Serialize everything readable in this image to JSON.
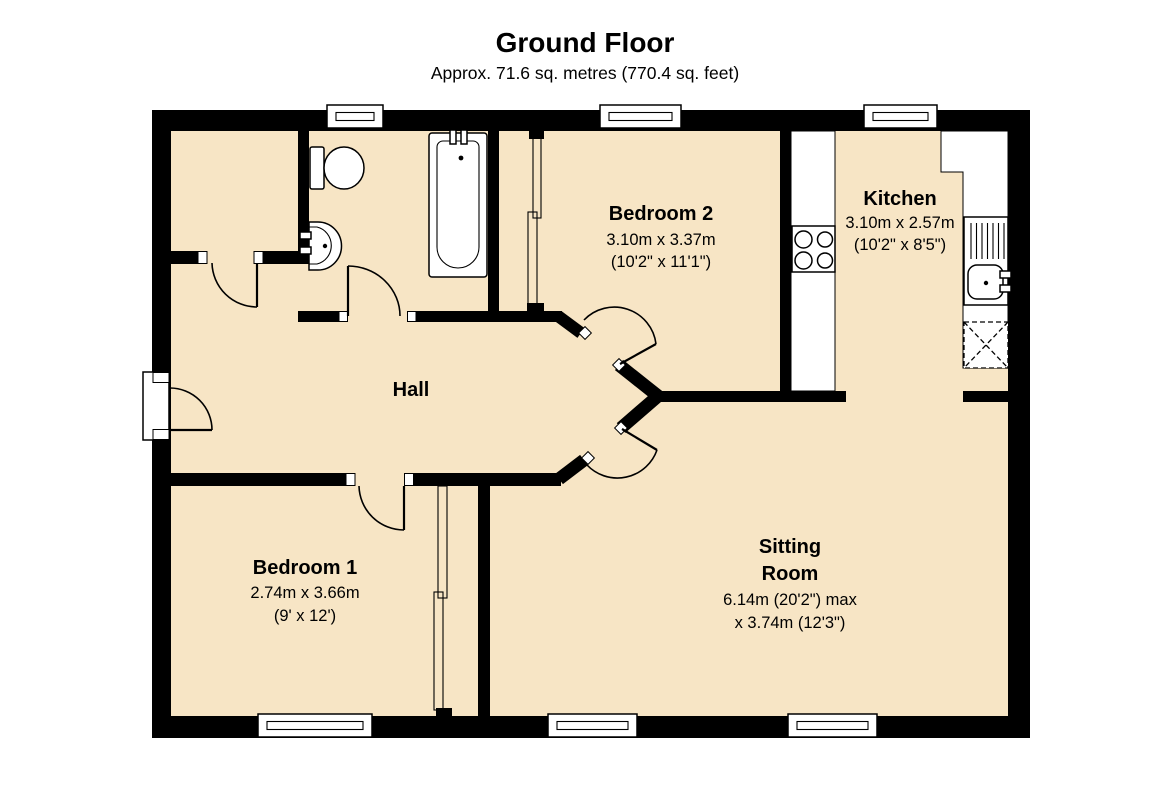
{
  "header": {
    "title": "Ground Floor",
    "subtitle": "Approx.  71.6 sq. metres (770.4 sq. feet)"
  },
  "rooms": {
    "bedroom2": {
      "name": "Bedroom 2",
      "dim_metric": "3.10m x 3.37m",
      "dim_imperial": "(10'2\" x 11'1\")"
    },
    "kitchen": {
      "name": "Kitchen",
      "dim_metric": "3.10m x 2.57m",
      "dim_imperial": "(10'2\" x 8'5\")"
    },
    "hall": {
      "name": "Hall"
    },
    "bedroom1": {
      "name": "Bedroom 1",
      "dim_metric": "2.74m x 3.66m",
      "dim_imperial": "(9' x 12')"
    },
    "sitting": {
      "name_line1": "Sitting",
      "name_line2": "Room",
      "dim_line1": "6.14m (20'2\") max",
      "dim_line2": "x 3.74m (12'3\")"
    }
  },
  "fixtures": [
    "toilet",
    "wash-basin",
    "bathtub",
    "hob",
    "kitchen-sink-drainer",
    "appliance-space",
    "sliding-wardrobe",
    "window",
    "door"
  ],
  "colors": {
    "floor_fill": "#F7E5C5",
    "wall": "#000000",
    "fixture_fill": "#FFFFFF"
  }
}
